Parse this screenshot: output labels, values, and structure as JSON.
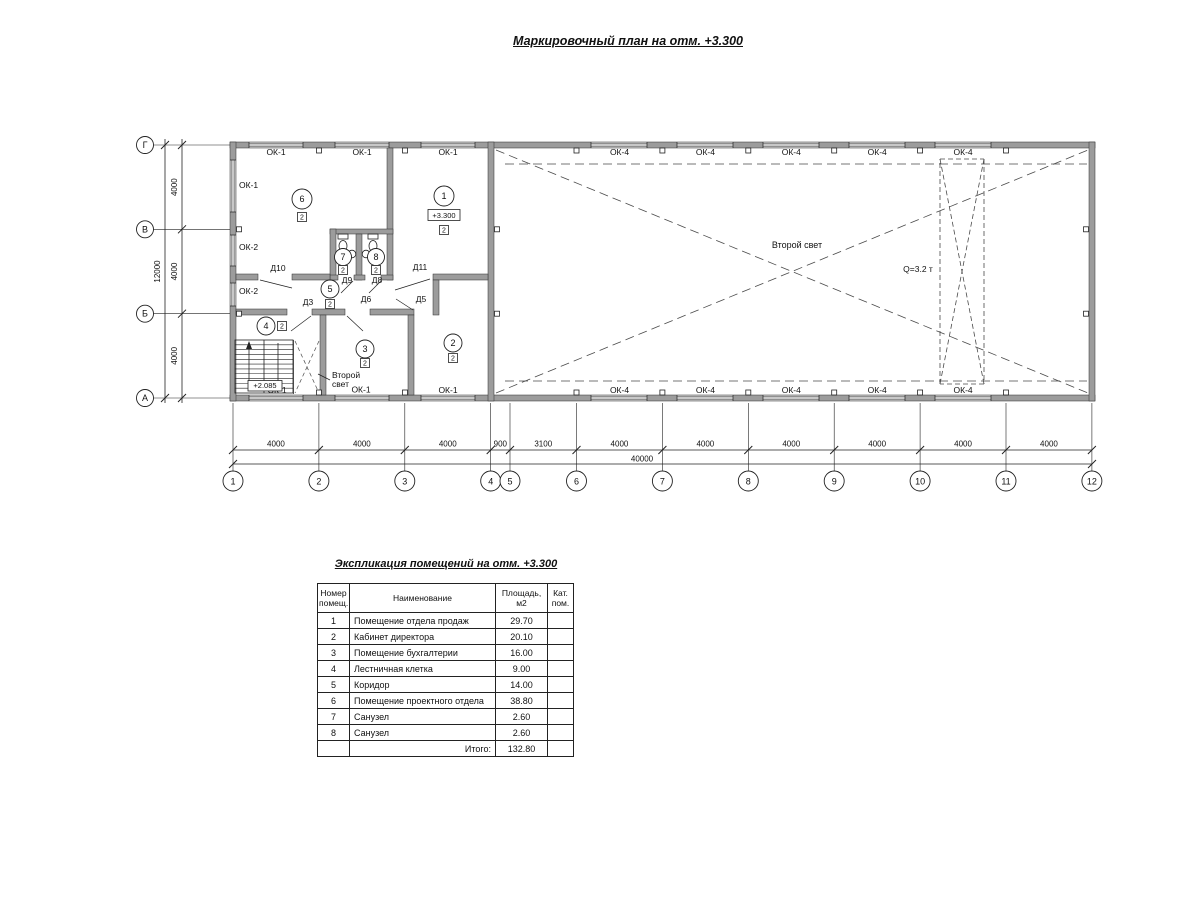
{
  "plan": {
    "title": "Маркировочный план на отм. +3.300",
    "grid": {
      "columns": [
        "1",
        "2",
        "3",
        "4",
        "5",
        "6",
        "7",
        "8",
        "9",
        "10",
        "11",
        "12"
      ],
      "column_dims": [
        "4000",
        "4000",
        "4000",
        "900",
        "3100",
        "4000",
        "4000",
        "4000",
        "4000",
        "4000",
        "4000"
      ],
      "total_width": "40000",
      "rows": [
        "Г",
        "В",
        "Б",
        "А"
      ],
      "row_dims": [
        "4000",
        "4000",
        "4000"
      ],
      "total_height": "12000"
    },
    "window_marks": {
      "ok1": "ОК-1",
      "ok2": "ОК-2",
      "ok4": "ОК-4"
    },
    "door_marks": [
      "Д10",
      "Д9",
      "Д8",
      "Д11",
      "Д3",
      "Д6",
      "Д5"
    ],
    "rooms": [
      {
        "number": "1",
        "category": "2",
        "elevation": "+3.300"
      },
      {
        "number": "2",
        "category": "2"
      },
      {
        "number": "3",
        "category": "2"
      },
      {
        "number": "4",
        "category": "2"
      },
      {
        "number": "5",
        "category": "2"
      },
      {
        "number": "6",
        "category": "2"
      },
      {
        "number": "7",
        "category": "2"
      },
      {
        "number": "8",
        "category": "2"
      }
    ],
    "stair_elevation": "+2.085",
    "labels": {
      "second_light_hall": "Второй свет",
      "second_light_stair": "Второй свет",
      "crane_capacity": "Q=3.2 т"
    }
  },
  "explication": {
    "title": "Экспликация помещений на отм. +3.300",
    "headers": {
      "number": "Номер помещ.",
      "name": "Наименование",
      "area": "Площадь, м2",
      "category": "Кат. пом."
    },
    "rows": [
      {
        "number": "1",
        "name": "Помещение отдела продаж",
        "area": "29.70",
        "category": ""
      },
      {
        "number": "2",
        "name": "Кабинет директора",
        "area": "20.10",
        "category": ""
      },
      {
        "number": "3",
        "name": "Помещение бухгалтерии",
        "area": "16.00",
        "category": ""
      },
      {
        "number": "4",
        "name": "Лестничная клетка",
        "area": "9.00",
        "category": ""
      },
      {
        "number": "5",
        "name": "Коридор",
        "area": "14.00",
        "category": ""
      },
      {
        "number": "6",
        "name": "Помещение проектного отдела",
        "area": "38.80",
        "category": ""
      },
      {
        "number": "7",
        "name": "Санузел",
        "area": "2.60",
        "category": ""
      },
      {
        "number": "8",
        "name": "Санузел",
        "area": "2.60",
        "category": ""
      }
    ],
    "total_label": "Итого:",
    "total_value": "132.80"
  }
}
